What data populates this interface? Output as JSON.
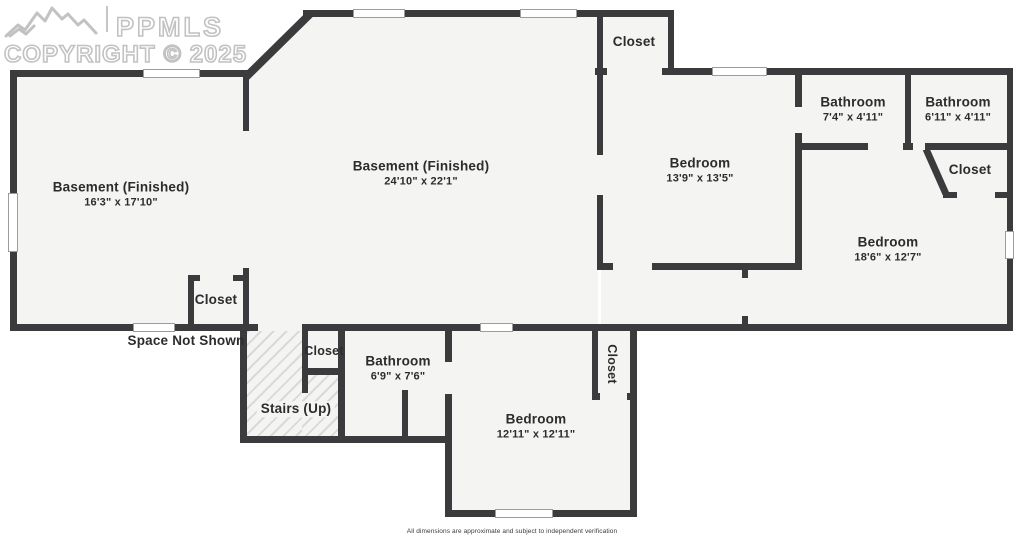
{
  "watermark": {
    "brand": "PPMLS",
    "copyright": "COPYRIGHT © 2025"
  },
  "rooms": [
    {
      "label": "Basement (Finished)",
      "dims": "16'3\" x 17'10\""
    },
    {
      "label": "Basement (Finished)",
      "dims": "24'10\" x 22'1\""
    },
    {
      "label": "Closet",
      "dims": ""
    },
    {
      "label": "Bedroom",
      "dims": "13'9\" x 13'5\""
    },
    {
      "label": "Bathroom",
      "dims": "7'4\" x 4'11\""
    },
    {
      "label": "Bathroom",
      "dims": "6'11\" x 4'11\""
    },
    {
      "label": "Closet",
      "dims": ""
    },
    {
      "label": "Bedroom",
      "dims": "18'6\" x 12'7\""
    },
    {
      "label": "Closet",
      "dims": ""
    },
    {
      "label": "Space Not Shown",
      "dims": ""
    },
    {
      "label": "Closet",
      "dims": ""
    },
    {
      "label": "Bathroom",
      "dims": "6'9\" x 7'6\""
    },
    {
      "label": "Stairs (Up)",
      "dims": ""
    },
    {
      "label": "Closet",
      "dims": ""
    },
    {
      "label": "Bedroom",
      "dims": "12'11\" x 12'11\""
    }
  ],
  "footer": {
    "disclaimer": "All dimensions are approximate and subject to independent verification"
  },
  "colors": {
    "wall": "#3b3b3d",
    "room_fill": "#f4f4f2",
    "window": "#ffffff"
  }
}
